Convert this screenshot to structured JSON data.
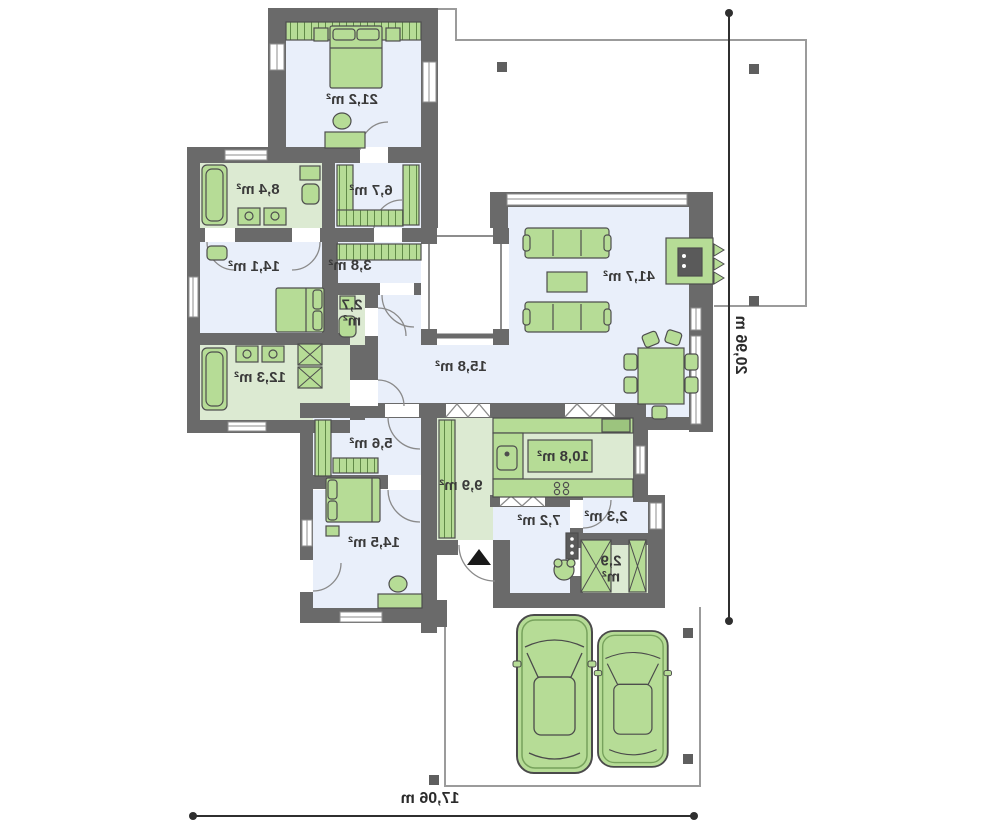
{
  "plan": {
    "rooms": [
      {
        "name": "bedroom-1",
        "area": "21,2 m²"
      },
      {
        "name": "bathroom-1",
        "area": "8,4 m²"
      },
      {
        "name": "wardrobe-1",
        "area": "6,7 m²"
      },
      {
        "name": "bedroom-2",
        "area": "14,1 m²"
      },
      {
        "name": "corridor-1",
        "area": "3,8 m²"
      },
      {
        "name": "wc",
        "area": "2,7 m²"
      },
      {
        "name": "living-room",
        "area": "41,7 m²"
      },
      {
        "name": "bathroom-2",
        "area": "12,3 m²"
      },
      {
        "name": "hall",
        "area": "15,8 m²"
      },
      {
        "name": "wardrobe-2",
        "area": "5,6 m²"
      },
      {
        "name": "entry",
        "area": "9,9 m²"
      },
      {
        "name": "kitchen",
        "area": "10,8 m²"
      },
      {
        "name": "corridor-2",
        "area": "7,2 m²"
      },
      {
        "name": "pantry",
        "area": "2,3 m²"
      },
      {
        "name": "utility",
        "area": "2,9 m²"
      },
      {
        "name": "bedroom-3",
        "area": "14,5 m²"
      }
    ],
    "dimensions": {
      "width_label": "17,06 m",
      "depth_label": "20,96 m"
    },
    "colors": {
      "wall": "#6a6a6a",
      "floor_blue": "#e9effa",
      "floor_green": "#dcead2",
      "furniture": "#b6dc96",
      "outline": "#9b9b9b"
    }
  }
}
